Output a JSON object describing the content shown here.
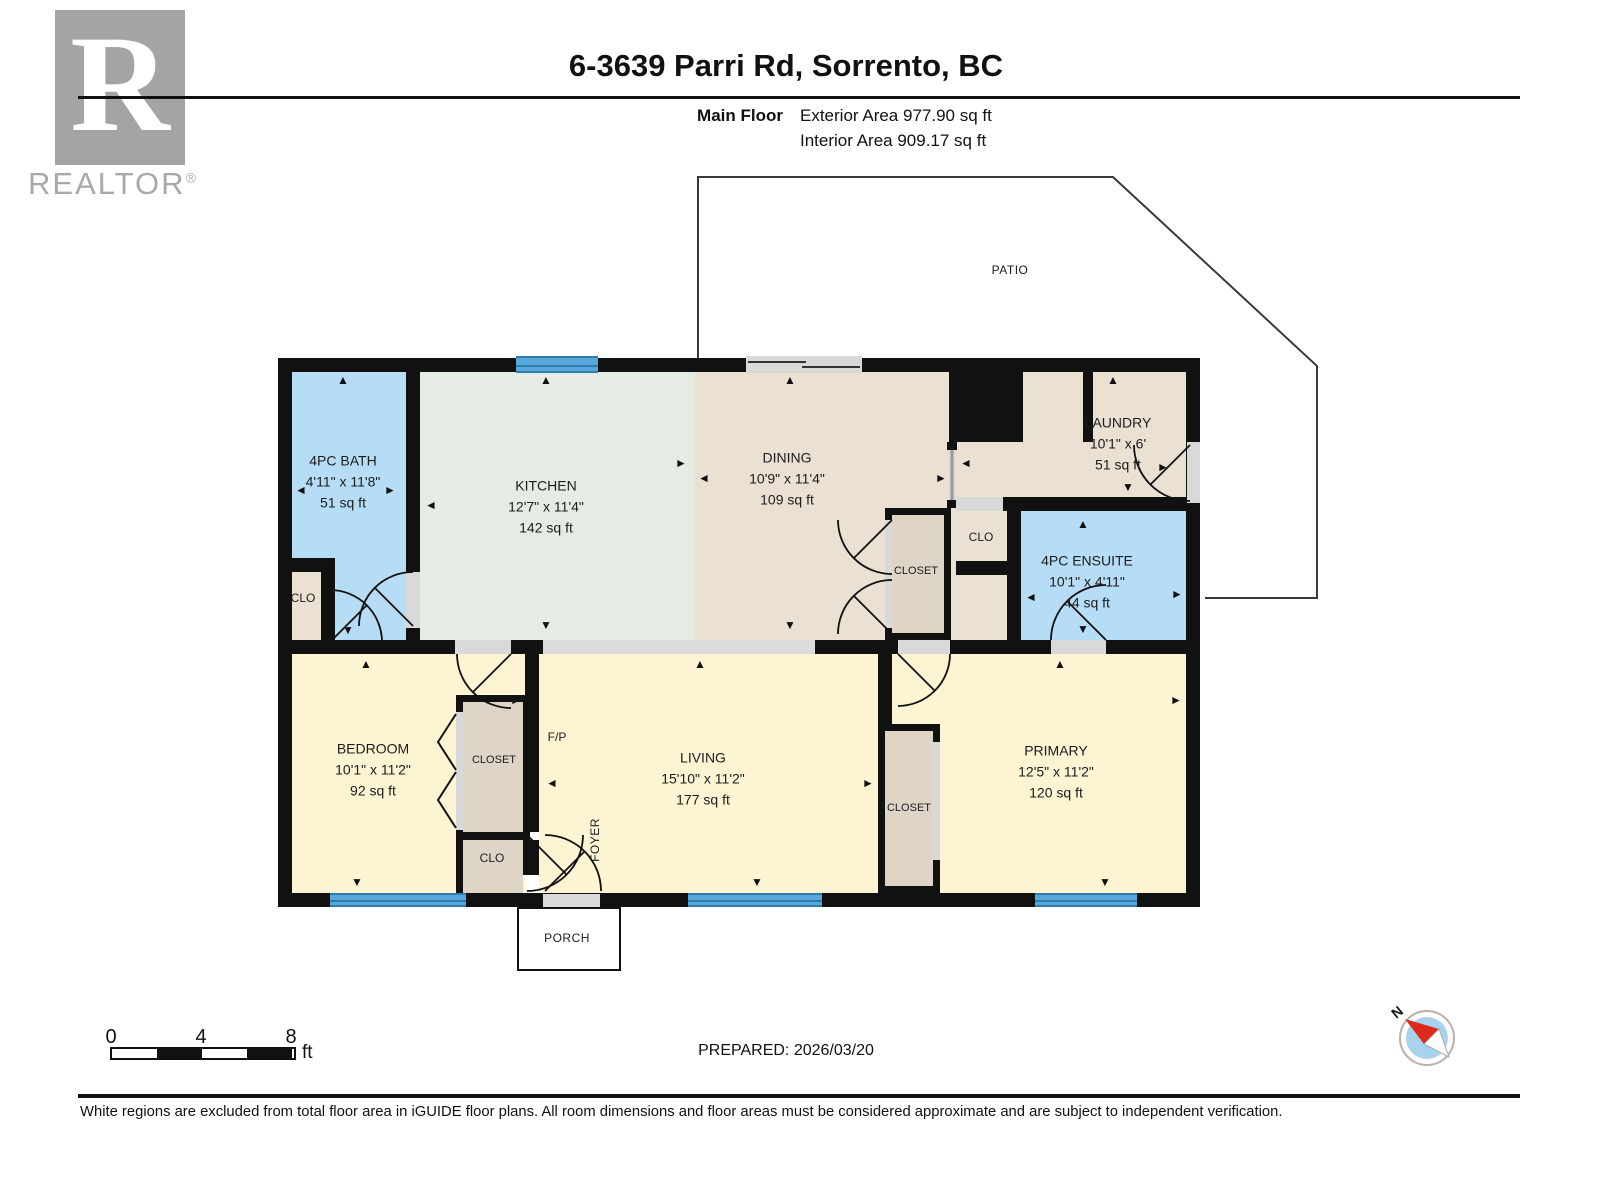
{
  "header": {
    "logo_letter": "R",
    "logo_text": "REALTOR",
    "logo_reg": "®",
    "title": "6-3639 Parri Rd, Sorrento, BC",
    "floor_label": "Main Floor",
    "exterior_area": "Exterior Area 977.90 sq ft",
    "interior_area": "Interior Area 909.17 sq ft"
  },
  "plan": {
    "rooms": [
      {
        "name": "4PC BATH",
        "dims": "4'11\" x 11'8\"",
        "area": "51 sq ft"
      },
      {
        "name": "KITCHEN",
        "dims": "12'7\" x 11'4\"",
        "area": "142 sq ft"
      },
      {
        "name": "DINING",
        "dims": "10'9\" x 11'4\"",
        "area": "109 sq ft"
      },
      {
        "name": "LAUNDRY",
        "dims": "10'1\" x 6'",
        "area": "51 sq ft"
      },
      {
        "name": "4PC ENSUITE",
        "dims": "10'1\" x 4'11\"",
        "area": "44 sq ft"
      },
      {
        "name": "BEDROOM",
        "dims": "10'1\" x 11'2\"",
        "area": "92 sq ft"
      },
      {
        "name": "LIVING",
        "dims": "15'10\" x 11'2\"",
        "area": "177 sq ft"
      },
      {
        "name": "PRIMARY",
        "dims": "12'5\" x 11'2\"",
        "area": "120 sq ft"
      }
    ],
    "labels": {
      "patio": "PATIO",
      "porch": "PORCH",
      "foyer": "FOYER",
      "fireplace": "F/P",
      "clo_bath": "CLO",
      "clo_hall": "CLO",
      "clo_bedroom": "CLO",
      "closet_dining": "CLOSET",
      "closet_bedroom": "CLOSET",
      "closet_primary": "CLOSET"
    }
  },
  "footer": {
    "scale": {
      "zero": "0",
      "four": "4",
      "eight": "8",
      "unit": "ft"
    },
    "prepared": "PREPARED: 2026/03/20",
    "compass_n": "N",
    "disclaimer": "White regions are excluded from total floor area in iGUIDE floor plans. All room dimensions and floor areas must be considered approximate and are subject to independent verification."
  },
  "icons": {
    "up": "▲",
    "down": "▼",
    "left": "◄",
    "right": "►"
  },
  "colors": {
    "wall": "#111111",
    "bath_blue": "#b7ddf6",
    "beige": "#eae1d2",
    "pale_yellow": "#fdf4d4",
    "kitchen_green": "#e4ece3",
    "closet_tan": "#ded5c6",
    "window_blue": "#57a7da",
    "opening_gray": "#d9d9d9",
    "logo_gray": "#a4a4a4",
    "compass_red": "#dd2a1a",
    "compass_blue": "#a7d3ee"
  }
}
